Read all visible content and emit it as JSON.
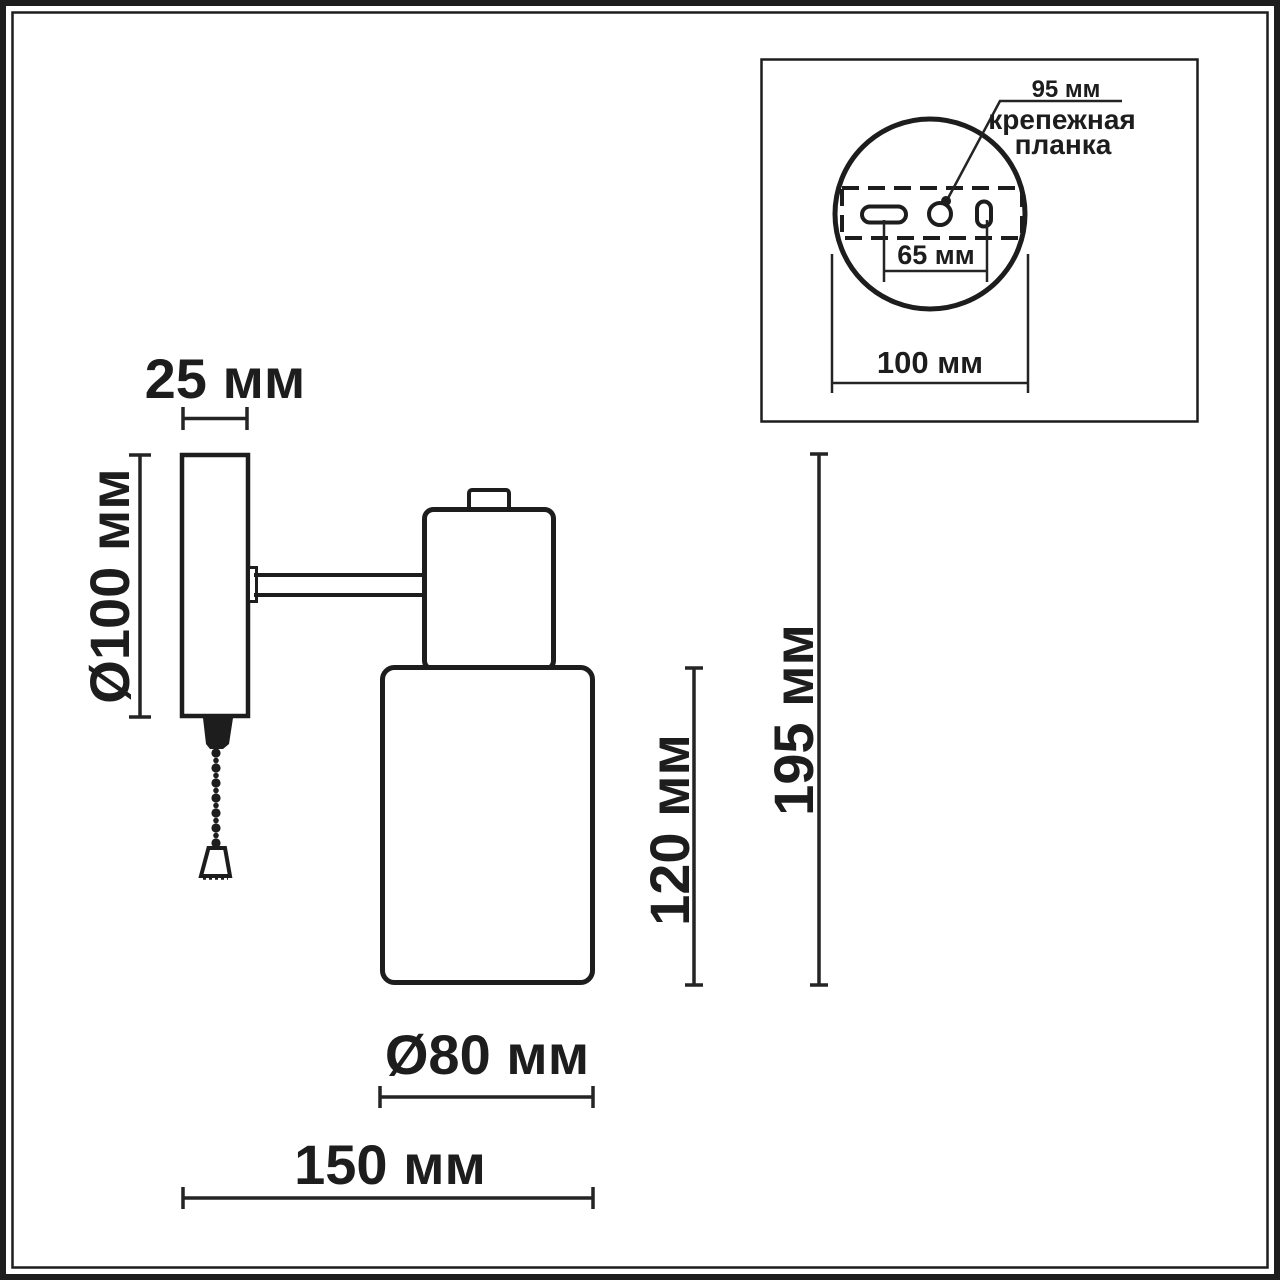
{
  "labels": {
    "plate_width": "25 мм",
    "plate_diameter": "Ø100 мм",
    "shade_diameter": "Ø80 мм",
    "depth": "150 мм",
    "shade_height": "120 мм",
    "total_height": "195 мм"
  },
  "inset": {
    "bracket_length": "95 мм",
    "bracket_name_line1": "крепежная",
    "bracket_name_line2": "планка",
    "hole_spacing": "65 мм",
    "base_diameter": "100 мм"
  },
  "colors": {
    "line": "#1d1d1d",
    "background": "#ffffff"
  }
}
